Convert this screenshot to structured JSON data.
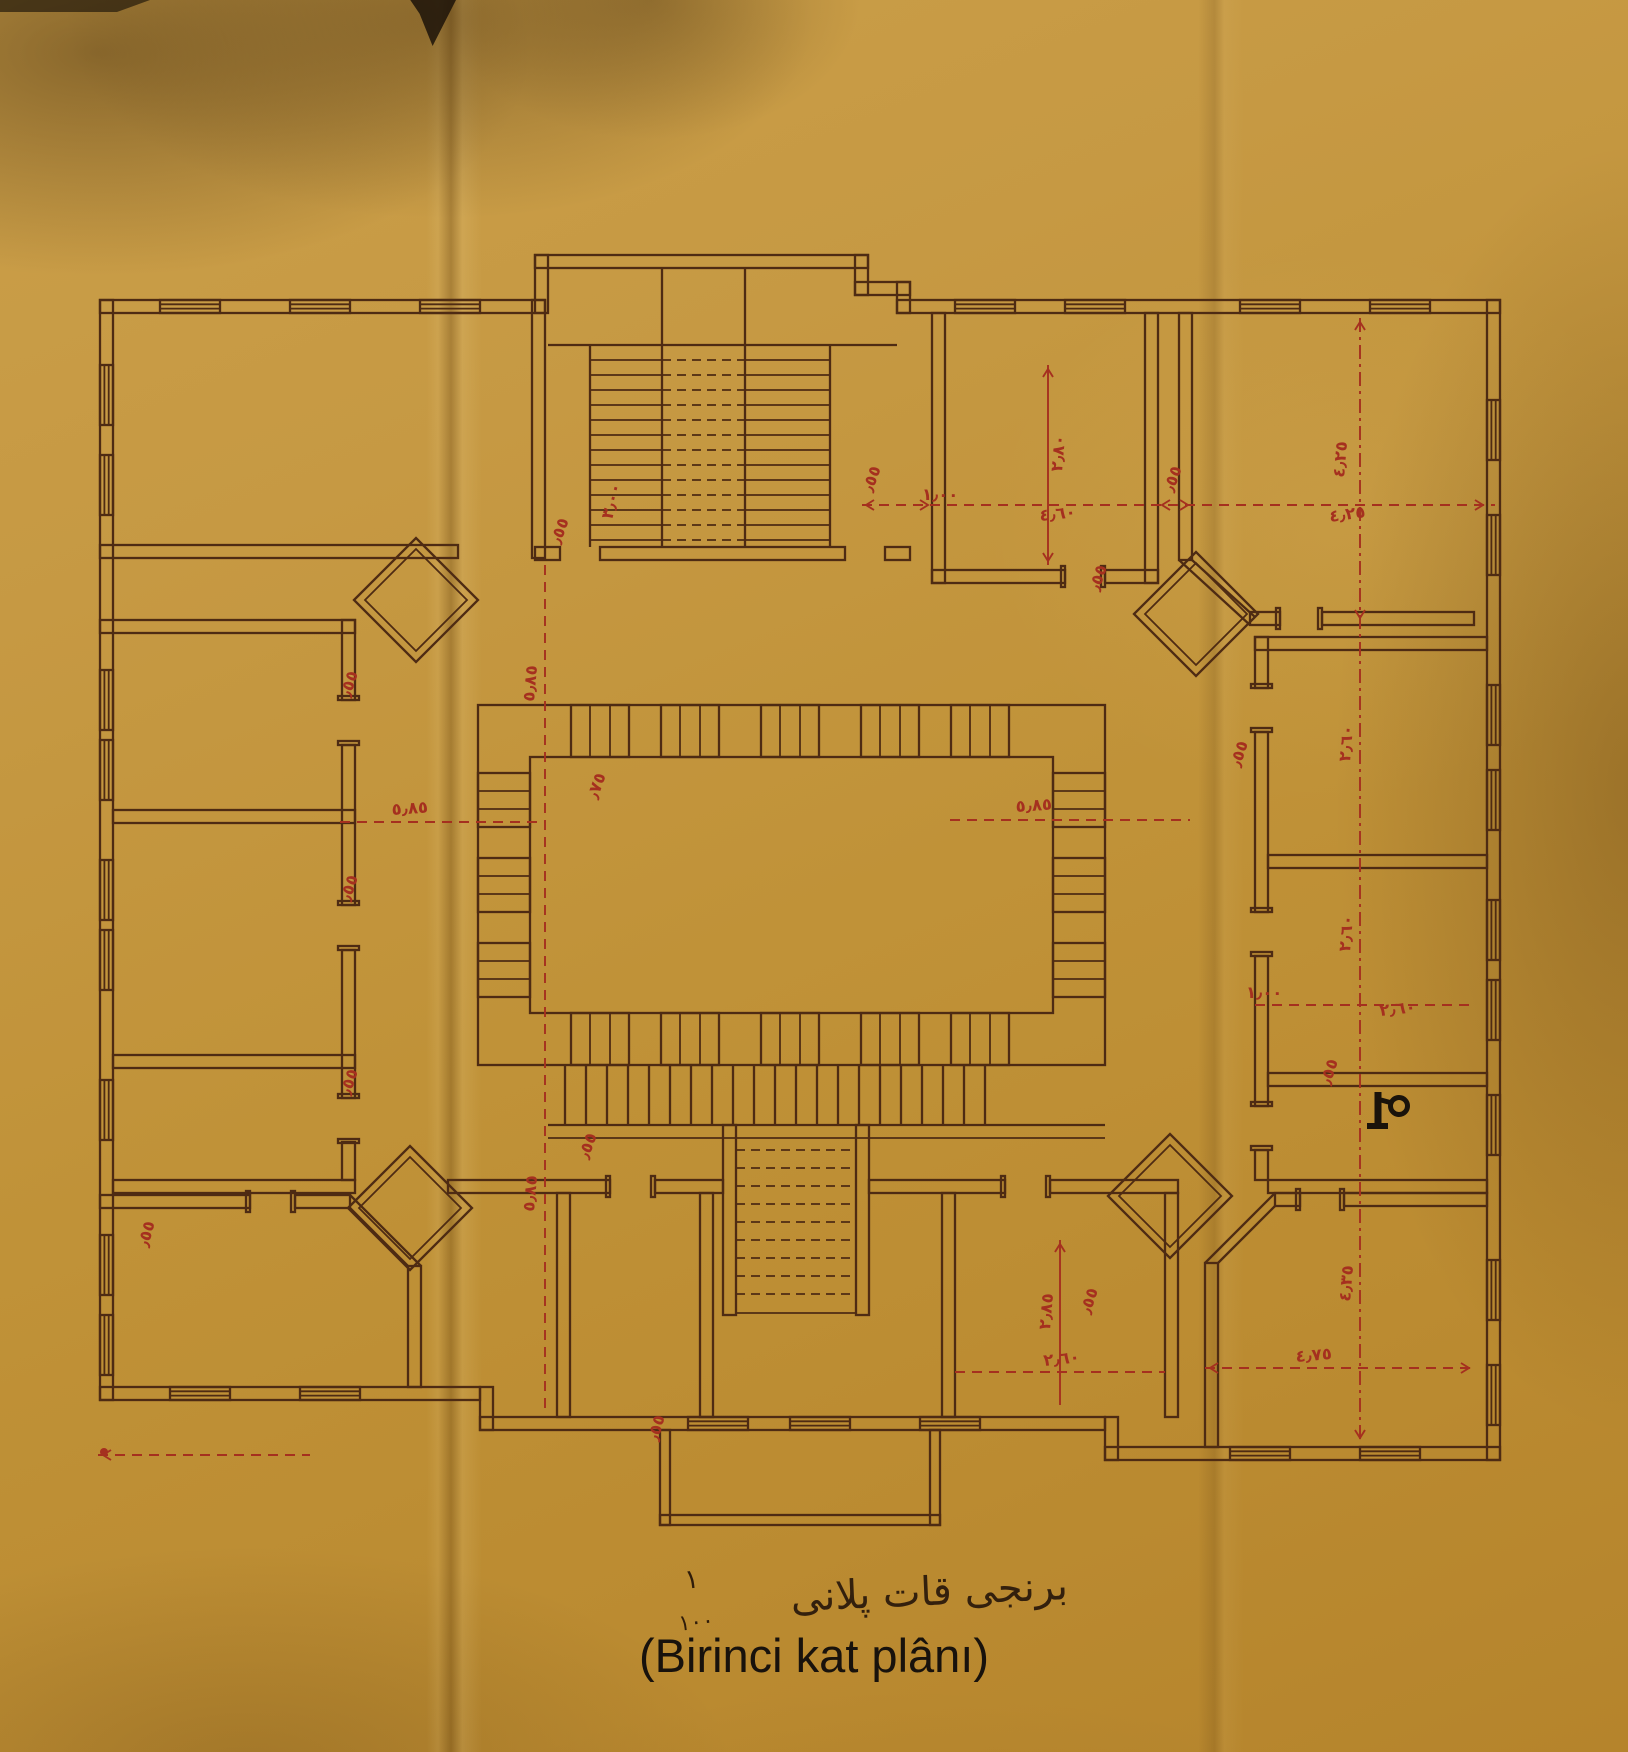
{
  "document": {
    "kind": "scanned Ottoman architectural drawing, first floor plan",
    "caption_latin": "(Birinci kat plânı)",
    "caption_ottoman": "برنجى قات پلانى",
    "scale_fraction": {
      "numerator": "١",
      "denominator": "١٠٠"
    }
  },
  "colors": {
    "paper": "#c09238",
    "ink": "#4e2b13",
    "dimension_red": "#a5301f",
    "caption_ink": "#18120c"
  },
  "plan": {
    "dimension_labels": [
      {
        "t": "٣٫٠٠",
        "x": 612,
        "y": 520,
        "r": -75
      },
      {
        "t": "٫٥٥",
        "x": 560,
        "y": 545,
        "r": -70
      },
      {
        "t": "١٫٠٠",
        "x": 922,
        "y": 500,
        "r": 0
      },
      {
        "t": "٫٥٥",
        "x": 872,
        "y": 493,
        "r": -70
      },
      {
        "t": "٤٫٦٠",
        "x": 1040,
        "y": 521,
        "r": -6
      },
      {
        "t": "٢٫٨٠",
        "x": 1062,
        "y": 472,
        "r": -85
      },
      {
        "t": "٫٥٥",
        "x": 1173,
        "y": 493,
        "r": -70
      },
      {
        "t": "٤٫٢٥",
        "x": 1330,
        "y": 522,
        "r": -8
      },
      {
        "t": "٤٫٢٥",
        "x": 1344,
        "y": 478,
        "r": -85
      },
      {
        "t": "٥٫٨٥",
        "x": 392,
        "y": 815,
        "r": -4
      },
      {
        "t": "٥٫٨٥",
        "x": 1016,
        "y": 812,
        "r": -4
      },
      {
        "t": "٥٫٨٥",
        "x": 534,
        "y": 702,
        "r": -85
      },
      {
        "t": "٥٫٨٥",
        "x": 534,
        "y": 1212,
        "r": -85
      },
      {
        "t": "٫٧٥",
        "x": 597,
        "y": 800,
        "r": -70
      },
      {
        "t": "٫٥٥",
        "x": 350,
        "y": 698,
        "r": -72
      },
      {
        "t": "٫٥٥",
        "x": 350,
        "y": 902,
        "r": -72
      },
      {
        "t": "٫٥٥",
        "x": 350,
        "y": 1096,
        "r": -72
      },
      {
        "t": "٫٥٥",
        "x": 1099,
        "y": 592,
        "r": -72
      },
      {
        "t": "٫٥٥",
        "x": 1240,
        "y": 768,
        "r": -72
      },
      {
        "t": "٢٫٦٠",
        "x": 1350,
        "y": 762,
        "r": -85
      },
      {
        "t": "٢٫٦٠",
        "x": 1350,
        "y": 952,
        "r": -85
      },
      {
        "t": "١٫٠٠",
        "x": 1246,
        "y": 998,
        "r": 0
      },
      {
        "t": "٢٫٦٠",
        "x": 1380,
        "y": 1016,
        "r": -6
      },
      {
        "t": "٫٥٥",
        "x": 1330,
        "y": 1086,
        "r": -72
      },
      {
        "t": "٤٫٣٥",
        "x": 1350,
        "y": 1302,
        "r": -85
      },
      {
        "t": "٤٫٧٥",
        "x": 1296,
        "y": 1362,
        "r": -5
      },
      {
        "t": "٢٫٨٥",
        "x": 1050,
        "y": 1330,
        "r": -85
      },
      {
        "t": "٢٫٦٠",
        "x": 1044,
        "y": 1366,
        "r": -6
      },
      {
        "t": "٫٥٥",
        "x": 1090,
        "y": 1315,
        "r": -72
      },
      {
        "t": "٫٥٥",
        "x": 588,
        "y": 1160,
        "r": -70
      },
      {
        "t": "٫٥٥",
        "x": 658,
        "y": 1442,
        "r": -75
      },
      {
        "t": "٫٥٥",
        "x": 148,
        "y": 1248,
        "r": -75
      }
    ]
  }
}
